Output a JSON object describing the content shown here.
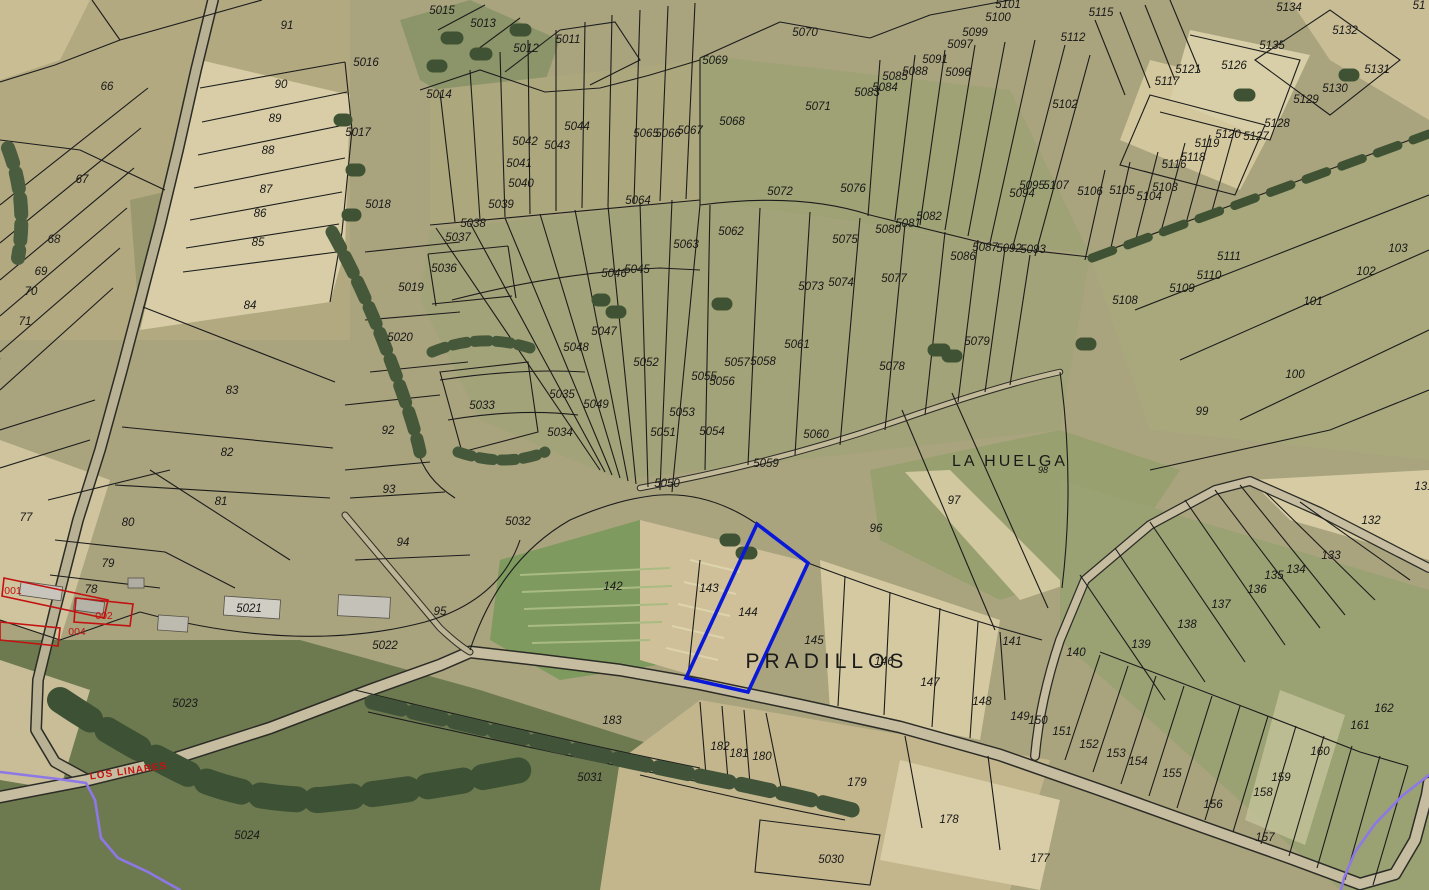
{
  "map": {
    "description": "Cadastral parcel map over aerial orthophoto",
    "place_labels": [
      {
        "t": "LA HUELGA",
        "x": 1010,
        "y": 466,
        "kind": "place-md",
        "rot": 0
      },
      {
        "t": "PRADILLOS",
        "x": 827,
        "y": 668,
        "kind": "place-lg",
        "rot": 0
      },
      {
        "t": "LOS LINARES",
        "x": 129,
        "y": 774,
        "kind": "route",
        "rot": -8
      }
    ],
    "red_parcel_labels": [
      {
        "t": "001",
        "x": 13,
        "y": 594
      },
      {
        "t": "002",
        "x": 104,
        "y": 619
      },
      {
        "t": "004",
        "x": 77,
        "y": 635
      }
    ],
    "highlighted_parcel": {
      "number": "144",
      "outline_color": "#0a18d8"
    },
    "colors": {
      "boundary": "#1c1c1c",
      "label": "#181818",
      "red": "#c41111",
      "highlight_blue": "#0a18d8",
      "route_purple": "#8d78e6",
      "road": "#c4bb9e"
    },
    "parcel_labels": [
      {
        "t": "66",
        "x": 107,
        "y": 90
      },
      {
        "t": "67",
        "x": 82,
        "y": 183
      },
      {
        "t": "68",
        "x": 54,
        "y": 243
      },
      {
        "t": "69",
        "x": 41,
        "y": 275
      },
      {
        "t": "70",
        "x": 31,
        "y": 295
      },
      {
        "t": "71",
        "x": 25,
        "y": 325
      },
      {
        "t": "72",
        "x": -6,
        "y": 365
      },
      {
        "t": "77",
        "x": 26,
        "y": 521
      },
      {
        "t": "78",
        "x": 91,
        "y": 593
      },
      {
        "t": "79",
        "x": 108,
        "y": 567
      },
      {
        "t": "80",
        "x": 128,
        "y": 526
      },
      {
        "t": "81",
        "x": 221,
        "y": 505
      },
      {
        "t": "82",
        "x": 227,
        "y": 456
      },
      {
        "t": "83",
        "x": 232,
        "y": 394
      },
      {
        "t": "84",
        "x": 250,
        "y": 309
      },
      {
        "t": "85",
        "x": 258,
        "y": 246
      },
      {
        "t": "86",
        "x": 260,
        "y": 217
      },
      {
        "t": "87",
        "x": 266,
        "y": 193
      },
      {
        "t": "88",
        "x": 268,
        "y": 154
      },
      {
        "t": "89",
        "x": 275,
        "y": 122
      },
      {
        "t": "90",
        "x": 281,
        "y": 88
      },
      {
        "t": "91",
        "x": 287,
        "y": 29
      },
      {
        "t": "92",
        "x": 388,
        "y": 434
      },
      {
        "t": "93",
        "x": 389,
        "y": 493
      },
      {
        "t": "94",
        "x": 403,
        "y": 546
      },
      {
        "t": "95",
        "x": 440,
        "y": 615
      },
      {
        "t": "96",
        "x": 876,
        "y": 532
      },
      {
        "t": "97",
        "x": 954,
        "y": 504
      },
      {
        "t": "98",
        "x": 1043,
        "y": 473,
        "kind": "sm"
      },
      {
        "t": "99",
        "x": 1202,
        "y": 415
      },
      {
        "t": "100",
        "x": 1295,
        "y": 378
      },
      {
        "t": "101",
        "x": 1313,
        "y": 305
      },
      {
        "t": "102",
        "x": 1366,
        "y": 275
      },
      {
        "t": "103",
        "x": 1398,
        "y": 252
      },
      {
        "t": "131",
        "x": 1424,
        "y": 490
      },
      {
        "t": "132",
        "x": 1371,
        "y": 524
      },
      {
        "t": "133",
        "x": 1331,
        "y": 559
      },
      {
        "t": "134",
        "x": 1296,
        "y": 573
      },
      {
        "t": "135",
        "x": 1274,
        "y": 579
      },
      {
        "t": "136",
        "x": 1257,
        "y": 593
      },
      {
        "t": "137",
        "x": 1221,
        "y": 608
      },
      {
        "t": "138",
        "x": 1187,
        "y": 628
      },
      {
        "t": "139",
        "x": 1141,
        "y": 648
      },
      {
        "t": "140",
        "x": 1076,
        "y": 656
      },
      {
        "t": "141",
        "x": 1012,
        "y": 645
      },
      {
        "t": "142",
        "x": 613,
        "y": 590
      },
      {
        "t": "143",
        "x": 709,
        "y": 592
      },
      {
        "t": "144",
        "x": 748,
        "y": 616
      },
      {
        "t": "145",
        "x": 814,
        "y": 644
      },
      {
        "t": "146",
        "x": 884,
        "y": 665
      },
      {
        "t": "147",
        "x": 930,
        "y": 686
      },
      {
        "t": "148",
        "x": 982,
        "y": 705
      },
      {
        "t": "149",
        "x": 1020,
        "y": 720
      },
      {
        "t": "150",
        "x": 1038,
        "y": 724
      },
      {
        "t": "151",
        "x": 1062,
        "y": 735
      },
      {
        "t": "152",
        "x": 1089,
        "y": 748
      },
      {
        "t": "153",
        "x": 1116,
        "y": 757
      },
      {
        "t": "154",
        "x": 1138,
        "y": 765
      },
      {
        "t": "155",
        "x": 1172,
        "y": 777
      },
      {
        "t": "156",
        "x": 1213,
        "y": 808
      },
      {
        "t": "157",
        "x": 1265,
        "y": 841
      },
      {
        "t": "158",
        "x": 1263,
        "y": 796
      },
      {
        "t": "159",
        "x": 1281,
        "y": 781
      },
      {
        "t": "160",
        "x": 1320,
        "y": 755
      },
      {
        "t": "161",
        "x": 1360,
        "y": 729
      },
      {
        "t": "162",
        "x": 1384,
        "y": 712
      },
      {
        "t": "177",
        "x": 1040,
        "y": 862
      },
      {
        "t": "178",
        "x": 949,
        "y": 823
      },
      {
        "t": "179",
        "x": 857,
        "y": 786
      },
      {
        "t": "180",
        "x": 762,
        "y": 760
      },
      {
        "t": "181",
        "x": 739,
        "y": 757
      },
      {
        "t": "182",
        "x": 720,
        "y": 750
      },
      {
        "t": "183",
        "x": 612,
        "y": 724
      },
      {
        "t": "5011",
        "x": 568,
        "y": 43
      },
      {
        "t": "5012",
        "x": 526,
        "y": 52
      },
      {
        "t": "5013",
        "x": 483,
        "y": 27
      },
      {
        "t": "5014",
        "x": 439,
        "y": 98
      },
      {
        "t": "5015",
        "x": 442,
        "y": 14
      },
      {
        "t": "5016",
        "x": 366,
        "y": 66
      },
      {
        "t": "5017",
        "x": 358,
        "y": 136
      },
      {
        "t": "5018",
        "x": 378,
        "y": 208
      },
      {
        "t": "5019",
        "x": 411,
        "y": 291
      },
      {
        "t": "5020",
        "x": 400,
        "y": 341
      },
      {
        "t": "5021",
        "x": 249,
        "y": 612
      },
      {
        "t": "5022",
        "x": 385,
        "y": 649
      },
      {
        "t": "5023",
        "x": 185,
        "y": 707
      },
      {
        "t": "5024",
        "x": 247,
        "y": 839
      },
      {
        "t": "5030",
        "x": 831,
        "y": 863
      },
      {
        "t": "5031",
        "x": 590,
        "y": 781
      },
      {
        "t": "5032",
        "x": 518,
        "y": 525
      },
      {
        "t": "5033",
        "x": 482,
        "y": 409
      },
      {
        "t": "5034",
        "x": 560,
        "y": 436
      },
      {
        "t": "5035",
        "x": 562,
        "y": 398
      },
      {
        "t": "5036",
        "x": 444,
        "y": 272
      },
      {
        "t": "5037",
        "x": 458,
        "y": 241
      },
      {
        "t": "5038",
        "x": 473,
        "y": 227
      },
      {
        "t": "5039",
        "x": 501,
        "y": 208
      },
      {
        "t": "5040",
        "x": 521,
        "y": 187
      },
      {
        "t": "5041",
        "x": 519,
        "y": 167
      },
      {
        "t": "5042",
        "x": 525,
        "y": 145
      },
      {
        "t": "5043",
        "x": 557,
        "y": 149
      },
      {
        "t": "5044",
        "x": 577,
        "y": 130
      },
      {
        "t": "5045",
        "x": 637,
        "y": 273
      },
      {
        "t": "5046",
        "x": 614,
        "y": 277
      },
      {
        "t": "5047",
        "x": 604,
        "y": 335
      },
      {
        "t": "5048",
        "x": 576,
        "y": 351
      },
      {
        "t": "5049",
        "x": 596,
        "y": 408
      },
      {
        "t": "5050",
        "x": 667,
        "y": 487
      },
      {
        "t": "5051",
        "x": 663,
        "y": 436
      },
      {
        "t": "5052",
        "x": 646,
        "y": 366
      },
      {
        "t": "5053",
        "x": 682,
        "y": 416
      },
      {
        "t": "5054",
        "x": 712,
        "y": 435
      },
      {
        "t": "5055",
        "x": 704,
        "y": 380
      },
      {
        "t": "5056",
        "x": 722,
        "y": 385
      },
      {
        "t": "5057",
        "x": 737,
        "y": 366
      },
      {
        "t": "5058",
        "x": 763,
        "y": 365
      },
      {
        "t": "5059",
        "x": 766,
        "y": 467
      },
      {
        "t": "5060",
        "x": 816,
        "y": 438
      },
      {
        "t": "5061",
        "x": 797,
        "y": 348
      },
      {
        "t": "5062",
        "x": 731,
        "y": 235
      },
      {
        "t": "5063",
        "x": 686,
        "y": 248
      },
      {
        "t": "5064",
        "x": 638,
        "y": 204
      },
      {
        "t": "5065",
        "x": 646,
        "y": 137
      },
      {
        "t": "5066",
        "x": 668,
        "y": 137
      },
      {
        "t": "5067",
        "x": 690,
        "y": 134
      },
      {
        "t": "5068",
        "x": 732,
        "y": 125
      },
      {
        "t": "5069",
        "x": 715,
        "y": 64
      },
      {
        "t": "5070",
        "x": 805,
        "y": 36
      },
      {
        "t": "5071",
        "x": 818,
        "y": 110
      },
      {
        "t": "5072",
        "x": 780,
        "y": 195
      },
      {
        "t": "5073",
        "x": 811,
        "y": 290
      },
      {
        "t": "5074",
        "x": 841,
        "y": 286
      },
      {
        "t": "5075",
        "x": 845,
        "y": 243
      },
      {
        "t": "5076",
        "x": 853,
        "y": 192
      },
      {
        "t": "5077",
        "x": 894,
        "y": 282
      },
      {
        "t": "5078",
        "x": 892,
        "y": 370
      },
      {
        "t": "5079",
        "x": 977,
        "y": 345
      },
      {
        "t": "5080",
        "x": 888,
        "y": 233
      },
      {
        "t": "5081",
        "x": 908,
        "y": 227
      },
      {
        "t": "5082",
        "x": 929,
        "y": 220
      },
      {
        "t": "5083",
        "x": 867,
        "y": 96
      },
      {
        "t": "5084",
        "x": 885,
        "y": 91
      },
      {
        "t": "5085",
        "x": 895,
        "y": 80
      },
      {
        "t": "5086",
        "x": 963,
        "y": 260
      },
      {
        "t": "5087",
        "x": 985,
        "y": 251
      },
      {
        "t": "5088",
        "x": 915,
        "y": 75
      },
      {
        "t": "5091",
        "x": 935,
        "y": 63
      },
      {
        "t": "5092",
        "x": 1009,
        "y": 252
      },
      {
        "t": "5093",
        "x": 1033,
        "y": 253
      },
      {
        "t": "5094",
        "x": 1022,
        "y": 197
      },
      {
        "t": "5095",
        "x": 1032,
        "y": 189
      },
      {
        "t": "5096",
        "x": 958,
        "y": 76
      },
      {
        "t": "5097",
        "x": 960,
        "y": 48
      },
      {
        "t": "5099",
        "x": 975,
        "y": 36
      },
      {
        "t": "5100",
        "x": 998,
        "y": 21
      },
      {
        "t": "5101",
        "x": 1008,
        "y": 8
      },
      {
        "t": "5102",
        "x": 1065,
        "y": 108
      },
      {
        "t": "5103",
        "x": 1165,
        "y": 191
      },
      {
        "t": "5104",
        "x": 1149,
        "y": 200
      },
      {
        "t": "5105",
        "x": 1122,
        "y": 194
      },
      {
        "t": "5106",
        "x": 1090,
        "y": 195
      },
      {
        "t": "5107",
        "x": 1056,
        "y": 189
      },
      {
        "t": "5108",
        "x": 1125,
        "y": 304
      },
      {
        "t": "5109",
        "x": 1182,
        "y": 292
      },
      {
        "t": "5110",
        "x": 1209,
        "y": 279
      },
      {
        "t": "5111",
        "x": 1229,
        "y": 260
      },
      {
        "t": "5112",
        "x": 1073,
        "y": 41
      },
      {
        "t": "5115",
        "x": 1101,
        "y": 16
      },
      {
        "t": "5116",
        "x": 1174,
        "y": 168
      },
      {
        "t": "5117",
        "x": 1167,
        "y": 85
      },
      {
        "t": "5118",
        "x": 1193,
        "y": 161
      },
      {
        "t": "5119",
        "x": 1207,
        "y": 147
      },
      {
        "t": "5120",
        "x": 1228,
        "y": 138
      },
      {
        "t": "5121",
        "x": 1188,
        "y": 73
      },
      {
        "t": "5126",
        "x": 1234,
        "y": 69
      },
      {
        "t": "5127",
        "x": 1256,
        "y": 140
      },
      {
        "t": "5128",
        "x": 1277,
        "y": 127
      },
      {
        "t": "5129",
        "x": 1306,
        "y": 103
      },
      {
        "t": "5130",
        "x": 1335,
        "y": 92
      },
      {
        "t": "5131",
        "x": 1377,
        "y": 73
      },
      {
        "t": "5132",
        "x": 1345,
        "y": 34
      },
      {
        "t": "5134",
        "x": 1289,
        "y": 11
      },
      {
        "t": "5135",
        "x": 1272,
        "y": 49
      },
      {
        "t": "51",
        "x": 1419,
        "y": 9
      }
    ]
  }
}
